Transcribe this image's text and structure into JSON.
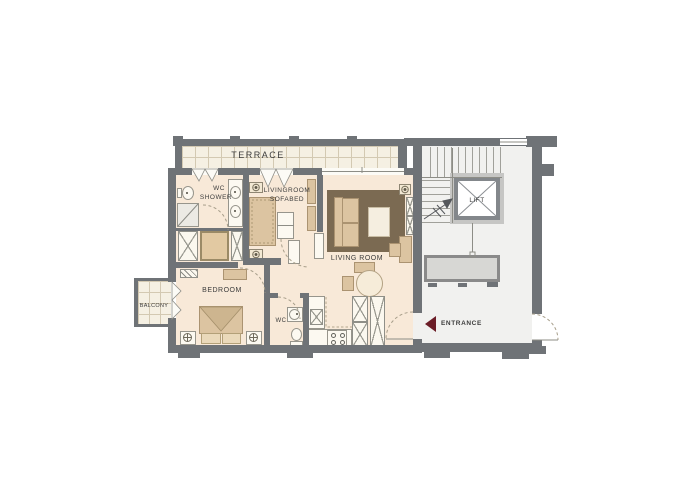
{
  "rooms": {
    "terrace": "TERRACE",
    "wc_shower_line1": "WC",
    "wc_shower_line2": "SHOWER",
    "sofabed_line1": "LIVINGROOM",
    "sofabed_line2": "SOFABED",
    "living_room": "LIVING ROOM",
    "bedroom": "BEDROOM",
    "balcony": "BALCONY",
    "wc": "WC",
    "lift": "LIFT",
    "entrance": "ENTRANCE"
  },
  "icons": {
    "entrance_arrow": "left-pointing-triangle"
  },
  "colors": {
    "wall": "#6f7377",
    "apartment_floor": "#f8e9d8",
    "terrace_floor": "#f5f0e3",
    "tile_line": "#d3c9b2",
    "rug": "#7b6a52",
    "furniture_tan": "#dcc4a1",
    "stairwell_floor": "#f1f1ef",
    "entrance_arrow": "#6b1d27",
    "label_text": "#3d3d3d"
  }
}
